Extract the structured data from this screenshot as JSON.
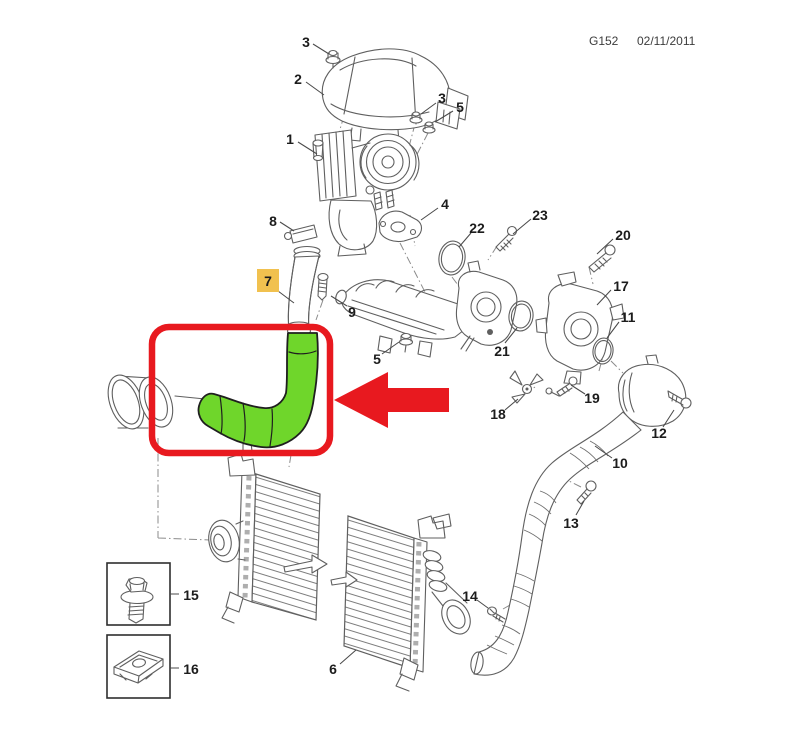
{
  "header": {
    "drawing_code": "G152",
    "date": "02/11/2011"
  },
  "highlight": {
    "part_number": "7",
    "label_bg": "#F1C14F",
    "label_border": "#DBA83B",
    "label_color": "#CF830E",
    "hose_fill": "#6FD62B",
    "hose_outline": "#1f1f1f",
    "marker_color": "#E8191F"
  },
  "callouts": {
    "shield_nut_top": "3",
    "heat_shield": "2",
    "turbo_nut_a": "3",
    "turbo_nut_b": "5",
    "turbocharger": "1",
    "clamp": "8",
    "gasket": "4",
    "bolt_23": "23",
    "seal_22": "22",
    "bolt_20": "20",
    "throttle_body_17": "17",
    "seal_11": "11",
    "highlighted_hose_7": "7",
    "stud_9": "9",
    "nut_5_mid": "5",
    "throttle_body_21": "21",
    "sensor_18": "18",
    "bolt_19": "19",
    "bolt_12": "12",
    "charge_hose_10": "10",
    "bolt_13": "13",
    "screw_14": "14",
    "intercooler_6": "6",
    "legend_screw_15": "15",
    "legend_clip_nut_16": "16"
  }
}
